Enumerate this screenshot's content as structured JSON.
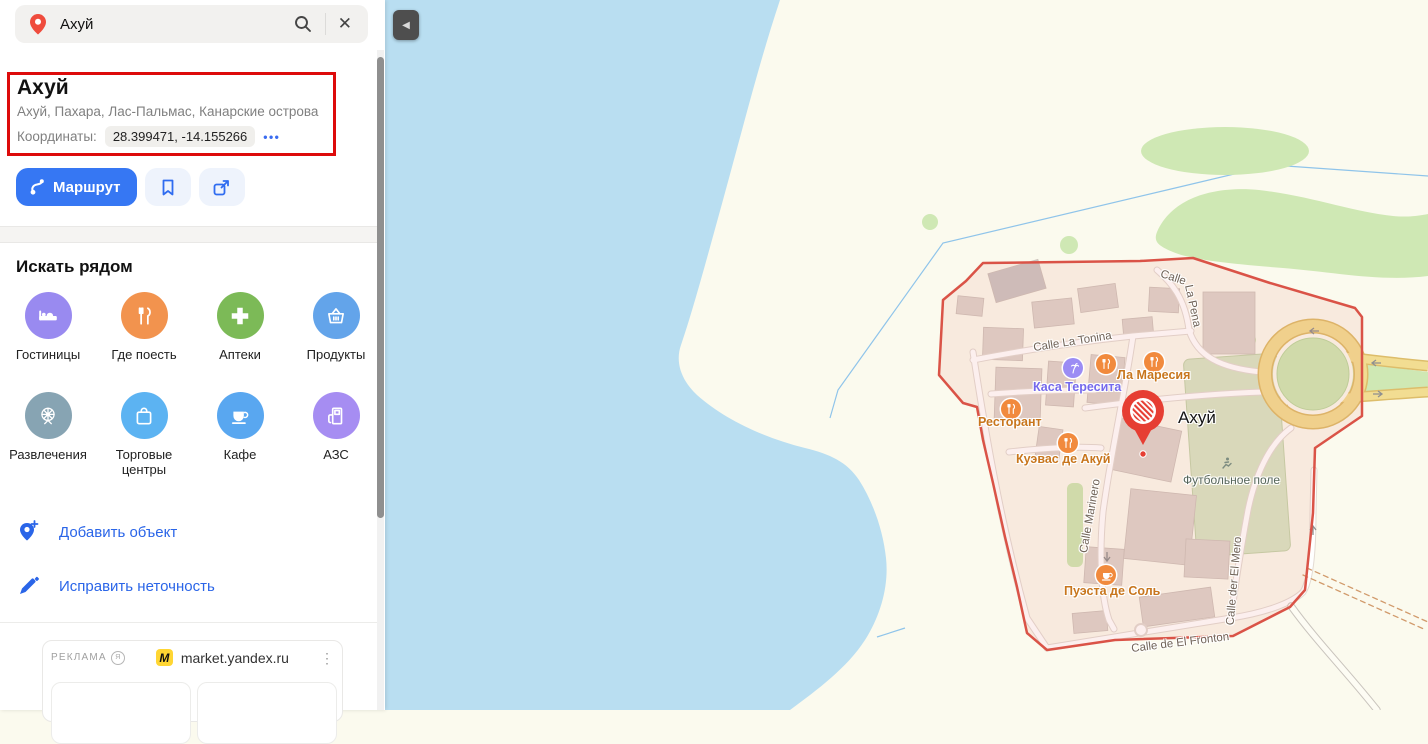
{
  "sidebar": {
    "search": {
      "value": "Ахуй"
    },
    "result": {
      "title": "Ахуй",
      "subtitle": "Ахуй, Пахара, Лас-Пальмас, Канарские острова",
      "coords_label": "Координаты:",
      "coords_value": "28.399471, -14.155266"
    },
    "actions": {
      "route_label": "Маршрут"
    },
    "nearby": {
      "heading": "Искать рядом",
      "items": [
        {
          "label": "Гостиницы",
          "icon": "bed-icon",
          "color": "#998af0"
        },
        {
          "label": "Где поесть",
          "icon": "restaurant-icon",
          "color": "#f2934e"
        },
        {
          "label": "Аптеки",
          "icon": "plus-icon",
          "color": "#7cba57"
        },
        {
          "label": "Продукты",
          "icon": "basket-icon",
          "color": "#63a4ea"
        },
        {
          "label": "Развлечения",
          "icon": "ferris-wheel-icon",
          "color": "#87a4b3"
        },
        {
          "label": "Торговые центры",
          "icon": "bag-icon",
          "color": "#5cb3f2"
        },
        {
          "label": "Кафе",
          "icon": "cup-icon",
          "color": "#59a7f0"
        },
        {
          "label": "АЗС",
          "icon": "fuel-icon",
          "color": "#a68df2"
        }
      ]
    },
    "links": [
      {
        "label": "Добавить объект"
      },
      {
        "label": "Исправить неточность"
      }
    ],
    "ad": {
      "badge": "РЕКЛАМА",
      "site": "market.yandex.ru"
    }
  },
  "map": {
    "place_label": "Ахуй",
    "streets": [
      "Calle La Tonina",
      "Calle La Pena",
      "Calle Marinero",
      "Calle der El Mero",
      "Calle de El Fronton"
    ],
    "pena_parts": [
      "Calle",
      "La Pena"
    ],
    "pois": [
      {
        "name": "Каса Тересита"
      },
      {
        "name": "Ла Маресия"
      },
      {
        "name": "Ресторант"
      },
      {
        "name": "Куэвас де Акуй"
      },
      {
        "name": "Пуэста де Соль"
      },
      {
        "name": "Футбольное поле"
      }
    ]
  },
  "icons": {
    "collapse": "◀",
    "close": "✕",
    "more_dots": "•••",
    "kebab": "⋮",
    "ad_info": "Я"
  },
  "colors": {
    "accent_blue": "#3677f3",
    "link_blue": "#2a65e8",
    "pin_red": "#e63e33",
    "region_stroke": "#da5347",
    "water": "#b9def1",
    "land": "#fbfaee",
    "green": "#cfe8b4"
  }
}
